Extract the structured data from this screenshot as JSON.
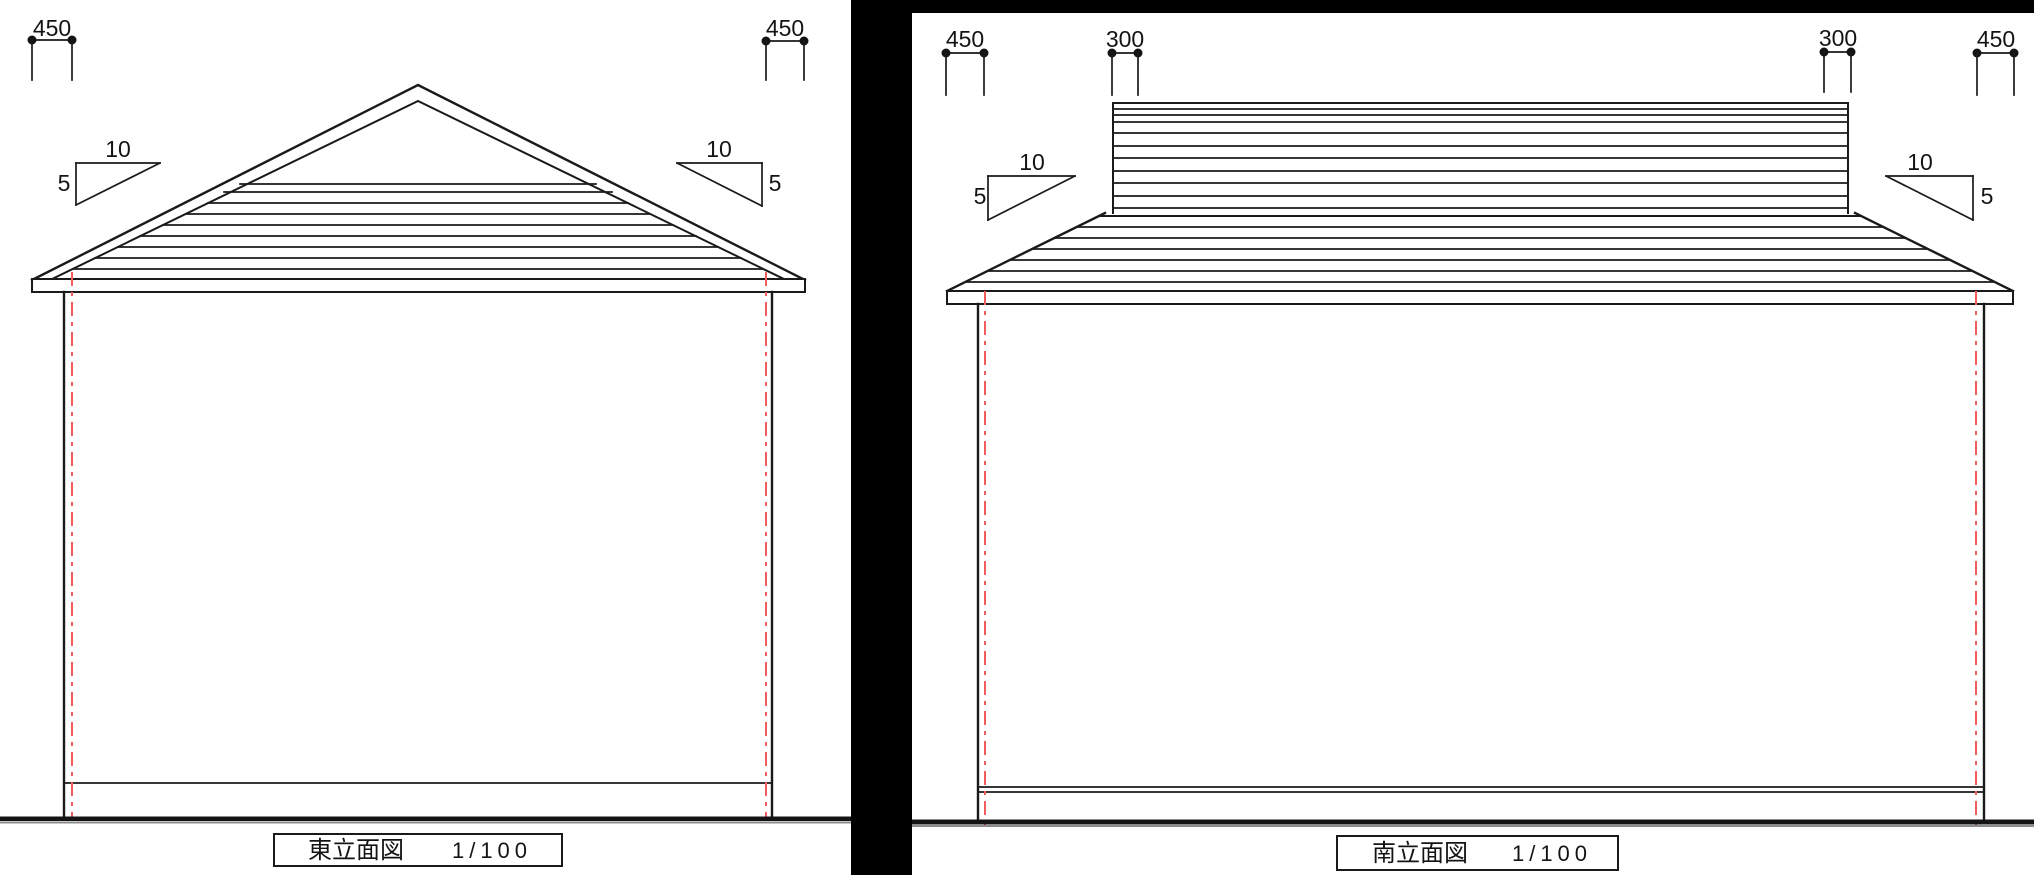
{
  "colors": {
    "background": "#ffffff",
    "ink": "#1a1a1a",
    "centerline_red": "#f25c5c",
    "divider_black": "#000000",
    "ground_shadow": "#8c8c8c"
  },
  "east_elevation": {
    "title": "東立面図",
    "scale_label": "1/100",
    "dimensions": {
      "left_eave_overhang": "450",
      "right_eave_overhang": "450"
    },
    "slope_left": {
      "run": "10",
      "rise": "5"
    },
    "slope_right": {
      "run": "10",
      "rise": "5"
    }
  },
  "south_elevation": {
    "title": "南立面図",
    "scale_label": "1/100",
    "dimensions": {
      "left_eave_overhang": "450",
      "left_gable_overhang": "300",
      "right_gable_overhang": "300",
      "right_eave_overhang": "450"
    },
    "slope_left": {
      "run": "10",
      "rise": "5"
    },
    "slope_right": {
      "run": "10",
      "rise": "5"
    }
  }
}
